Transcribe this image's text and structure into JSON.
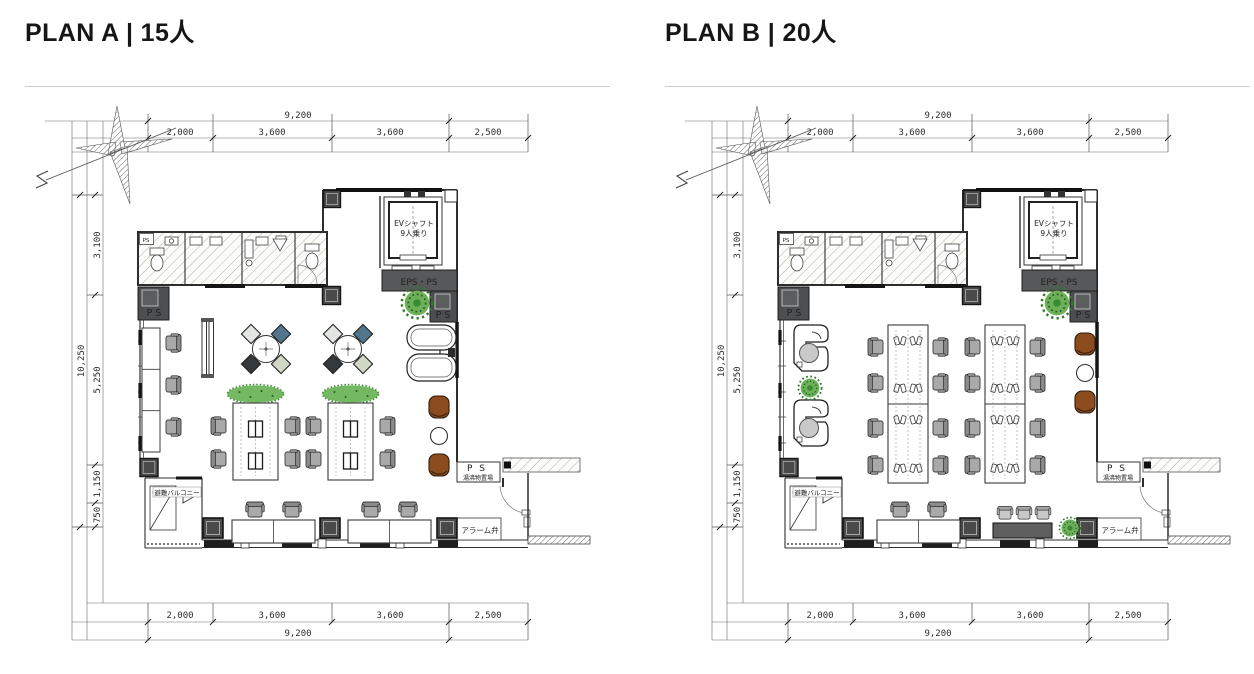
{
  "palette": {
    "line": "#2e2e2e",
    "column_dark": "#4a4a4a",
    "eps_band": "#57585a",
    "chair_gray": "#a9a9a9",
    "lounge_brown": "#8d4c1e",
    "plant_green": "#58a04b",
    "meeting_chair_blue": "#53758c",
    "meeting_chair_sage": "#cfd8c2",
    "meeting_chair_charcoal": "#35393c",
    "meeting_chair_white": "#e3e5e2"
  },
  "plans": [
    {
      "title": "PLAN A | 15人",
      "dims": {
        "top_total": "9,200",
        "top_segs": [
          "2,000",
          "3,600",
          "3,600",
          "2,500"
        ],
        "left_total": "10,250",
        "left_segs": [
          "3,100",
          "5,250",
          "1,150",
          "750"
        ],
        "bottom_segs": [
          "2,000",
          "3,600",
          "3,600",
          "2,500"
        ],
        "bottom_total": "9,200"
      },
      "labels": {
        "north": "N",
        "ev_shaft": "EVシャフト",
        "ev_capacity": "9人乗り",
        "eps_ps": "EPS・PS",
        "ps_left": "P S",
        "ps_right": "P S",
        "ps_small": "PS",
        "ps_entry": "P S",
        "entry_storage": "湯沸物置場",
        "evac": "避難バルコニー",
        "alarm": "アラーム弁"
      }
    },
    {
      "title": "PLAN B | 20人",
      "dims": {
        "top_total": "9,200",
        "top_segs": [
          "2,000",
          "3,600",
          "3,600",
          "2,500"
        ],
        "left_total": "10,250",
        "left_segs": [
          "3,100",
          "5,250",
          "1,150",
          "750"
        ],
        "bottom_segs": [
          "2,000",
          "3,600",
          "3,600",
          "2,500"
        ],
        "bottom_total": "9,200"
      },
      "labels": {
        "north": "N",
        "ev_shaft": "EVシャフト",
        "ev_capacity": "9人乗り",
        "eps_ps": "EPS・PS",
        "ps_left": "P S",
        "ps_right": "P S",
        "ps_small": "PS",
        "ps_entry": "P S",
        "entry_storage": "湯沸物置場",
        "evac": "避難バルコニー",
        "alarm": "アラーム弁"
      }
    }
  ]
}
